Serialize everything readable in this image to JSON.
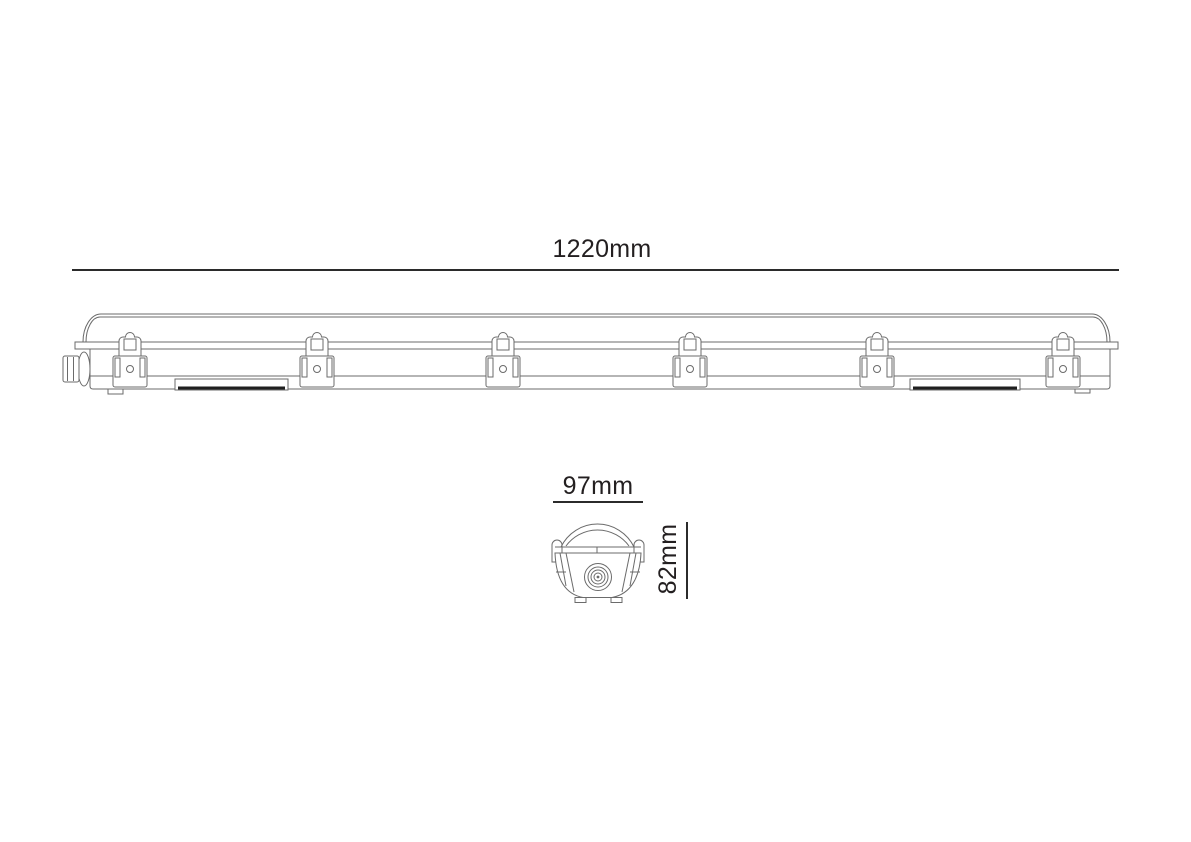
{
  "drawing": {
    "subject": "linear-batten-luminaire-technical-drawing",
    "dimensions": {
      "length": "1220mm",
      "width": "97mm",
      "height": "82mm"
    },
    "side_view": {
      "clip_count": 6
    },
    "colors": {
      "line": "#6b6b6b",
      "dimension_line": "#2b2b2b",
      "text": "#231f20",
      "sticker_stripe": "#1f1f1f",
      "background": "#ffffff"
    }
  }
}
